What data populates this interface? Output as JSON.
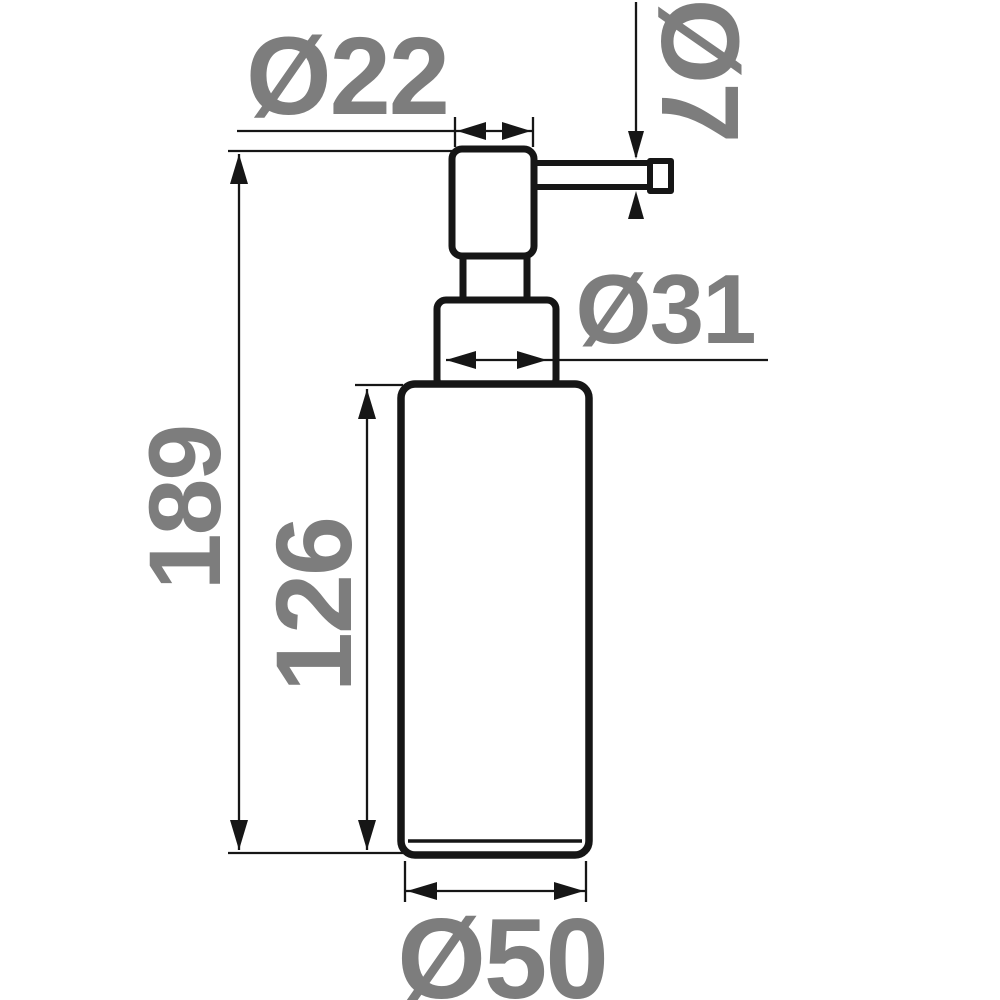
{
  "figure": {
    "type": "technical-dimension-drawing",
    "subject": "soap-dispenser-pump-bottle-side-view"
  },
  "colors": {
    "line": "#161616",
    "dimension_text": "#7d7d7d",
    "background": "#ffffff"
  },
  "dims": {
    "pump_head_diameter": {
      "label": "Ø22"
    },
    "spout_diameter": {
      "label": "Ø7"
    },
    "collar_diameter": {
      "label": "Ø31"
    },
    "body_diameter": {
      "label": "Ø50"
    },
    "total_height": {
      "label": "189"
    },
    "body_height": {
      "label": "126"
    }
  }
}
